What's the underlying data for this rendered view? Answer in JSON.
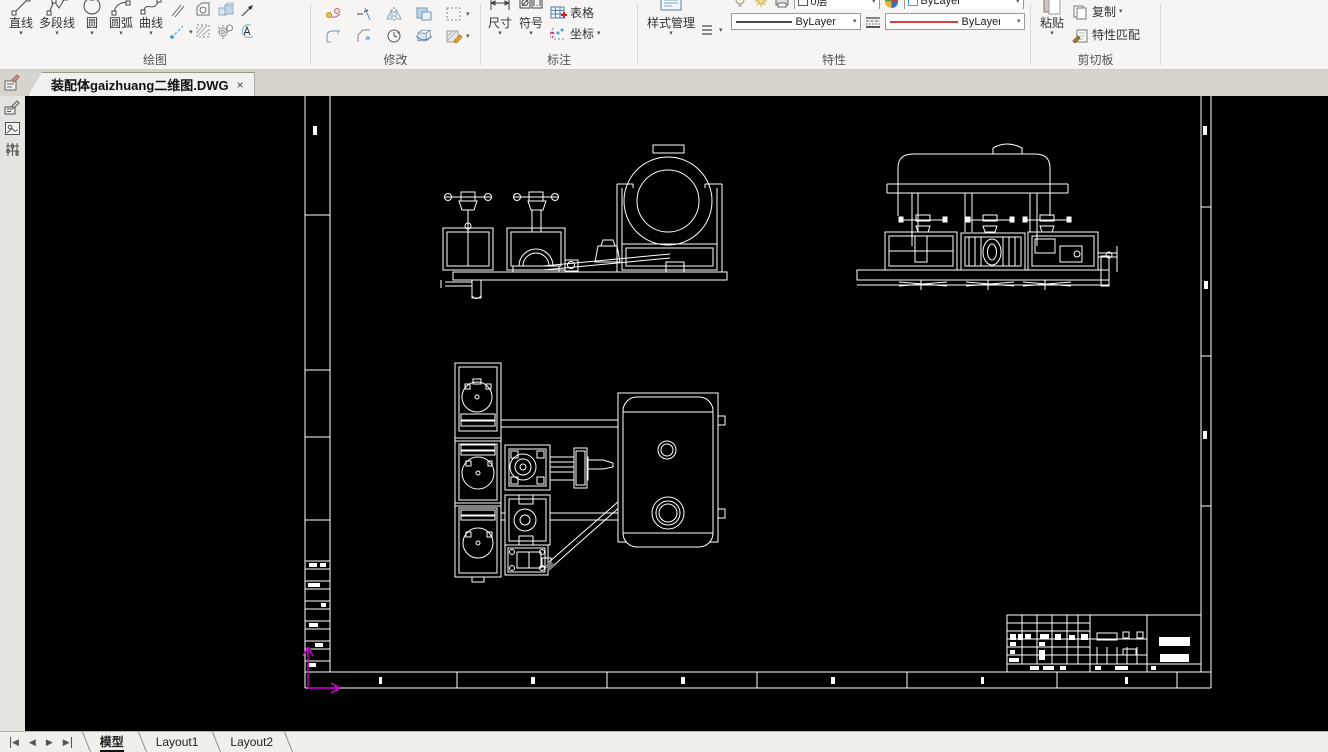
{
  "glyphs": {
    "dropdown": "▾",
    "close": "×",
    "prev": "◀",
    "next": "▶"
  },
  "ribbon": {
    "draw_group": {
      "label": "绘图",
      "buttons": [
        {
          "label": "直线"
        },
        {
          "label": "多段线"
        },
        {
          "label": "圆"
        },
        {
          "label": "圆弧"
        },
        {
          "label": "曲线"
        }
      ]
    },
    "modify_group": {
      "label": "修改"
    },
    "annotate_group": {
      "label": "标注",
      "dim_label": "尺寸",
      "symbol_label": "符号",
      "table_label": "表格",
      "coord_label": "坐标"
    },
    "properties_group": {
      "label": "特性",
      "style_manager_label": "样式管理",
      "layer_value": "0层",
      "color_value": "ByLayer",
      "lineweight_value": "ByLayer",
      "linetype_value": "ByLayer"
    },
    "clipboard_group": {
      "label": "剪切板",
      "paste_label": "粘贴",
      "copy_label": "复制",
      "match_label": "特性匹配"
    }
  },
  "document_tab": {
    "title": "装配体gaizhuang二维图.DWG"
  },
  "statusbar": {
    "model_tab": "模型",
    "layout1_tab": "Layout1",
    "layout2_tab": "Layout2"
  },
  "colors": {
    "canvas_bg": "#000000",
    "drawing_line": "#ffffff",
    "ucs_axis": "#d400d4",
    "linetype_red": "#cc0000",
    "ribbon_bg": "#f6f5f3"
  }
}
